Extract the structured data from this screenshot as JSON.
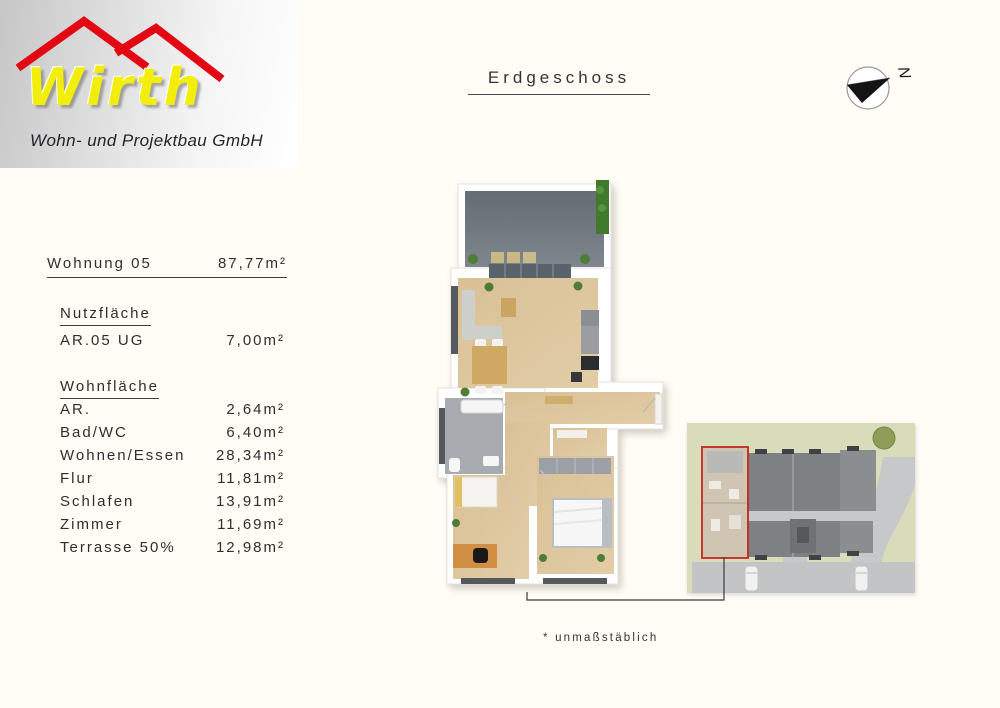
{
  "logo": {
    "brand": "Wirth",
    "subtitle": "Wohn- und Projektbau GmbH"
  },
  "header": {
    "title": "Erdgeschoss"
  },
  "compass": {
    "label": "N"
  },
  "apartment": {
    "name": "Wohnung 05",
    "total_area": "87,77m²",
    "nutzflaeche": {
      "heading": "Nutzfläche",
      "rows": [
        {
          "label": "AR.05 UG",
          "value": "7,00m²"
        }
      ]
    },
    "wohnflaeche": {
      "heading": "Wohnfläche",
      "rows": [
        {
          "label": "AR.",
          "value": "2,64m²"
        },
        {
          "label": "Bad/WC",
          "value": "6,40m²"
        },
        {
          "label": "Wohnen/Essen",
          "value": "28,34m²"
        },
        {
          "label": "Flur",
          "value": "11,81m²"
        },
        {
          "label": "Schlafen",
          "value": "13,91m²"
        },
        {
          "label": "Zimmer",
          "value": "11,69m²"
        },
        {
          "label": "Terrasse 50%",
          "value": "12,98m²"
        }
      ]
    }
  },
  "footnote": "* unmaßstäblich",
  "colors": {
    "page-bg": "#fffdf6",
    "roof-red": "#e30613",
    "brand-yellow": "#f2ee0a",
    "text": "#2e2e2e",
    "wood": "#d9c096",
    "wood-dark": "#c9a86e",
    "terrace": "#7f868d",
    "terrace-dark": "#646c74",
    "glazing": "#5a626b",
    "bath": "#a7abaf",
    "window": "#55585c",
    "plant": "#4e7d36",
    "hedge": "#3f7a2f",
    "site-bg": "#d8dcba",
    "site-building": "#7d8184",
    "site-building-light": "#8a8e91",
    "site-path": "#c6c8c9",
    "unit-fill": "#cfc5b2",
    "highlight-red": "#c2291c"
  }
}
